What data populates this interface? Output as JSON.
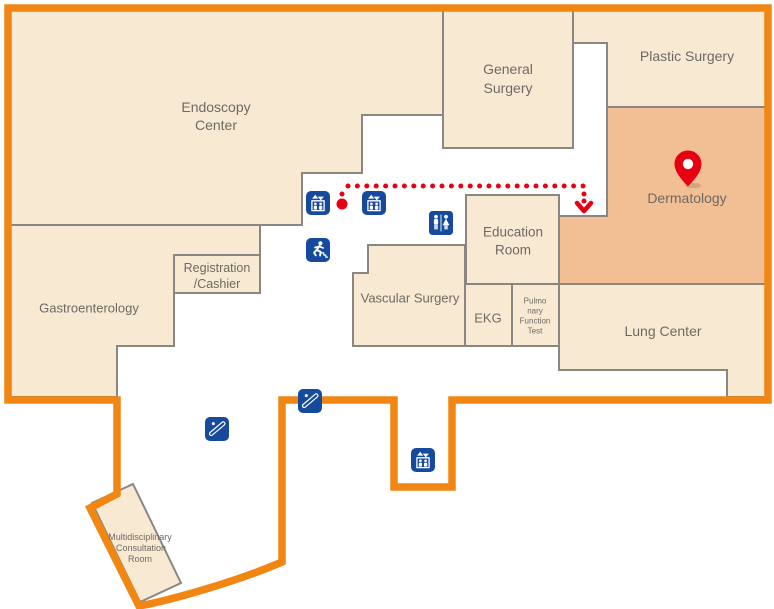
{
  "colors": {
    "outline": "#f28613",
    "room-fill": "#f8e9d2",
    "room-hl": "#f2bf94",
    "room-border": "#8a8782",
    "label": "#6d6a65",
    "icon-blue": "#164a9d",
    "route-red": "#e60012"
  },
  "rooms": {
    "endoscopy_center": {
      "line1": "Endoscopy",
      "line2": "Center"
    },
    "general_surgery": {
      "line1": "General",
      "line2": "Surgery"
    },
    "plastic_surgery": {
      "label": "Plastic Surgery"
    },
    "dermatology": {
      "label": "Dermatology"
    },
    "education_room": {
      "line1": "Education",
      "line2": "Room"
    },
    "vascular_surgery": {
      "label": "Vascular Surgery"
    },
    "ekg": {
      "label": "EKG"
    },
    "pulmonary_function_test": {
      "line1": "Pulmo",
      "line2": "nary",
      "line3": "Function",
      "line4": "Test"
    },
    "lung_center": {
      "label": "Lung Center"
    },
    "registration_cashier": {
      "line1": "Registration",
      "line2": "/Cashier"
    },
    "gastroenterology": {
      "label": "Gastroenterology"
    },
    "multidisciplinary_consultation_room": {
      "line1": "Multidisciplinary",
      "line2": "Consultation",
      "line3": "Room"
    }
  },
  "markers": {
    "elevator_count": 3,
    "escalator_count": 2,
    "restroom_count": 1,
    "emergency_exit_count": 1,
    "icon_names": [
      "elevator-icon",
      "restroom-icon",
      "emergency-exit-icon",
      "escalator-icon",
      "location-pin-icon"
    ],
    "route": {
      "style": "dotted",
      "destination": "Dermatology"
    }
  }
}
